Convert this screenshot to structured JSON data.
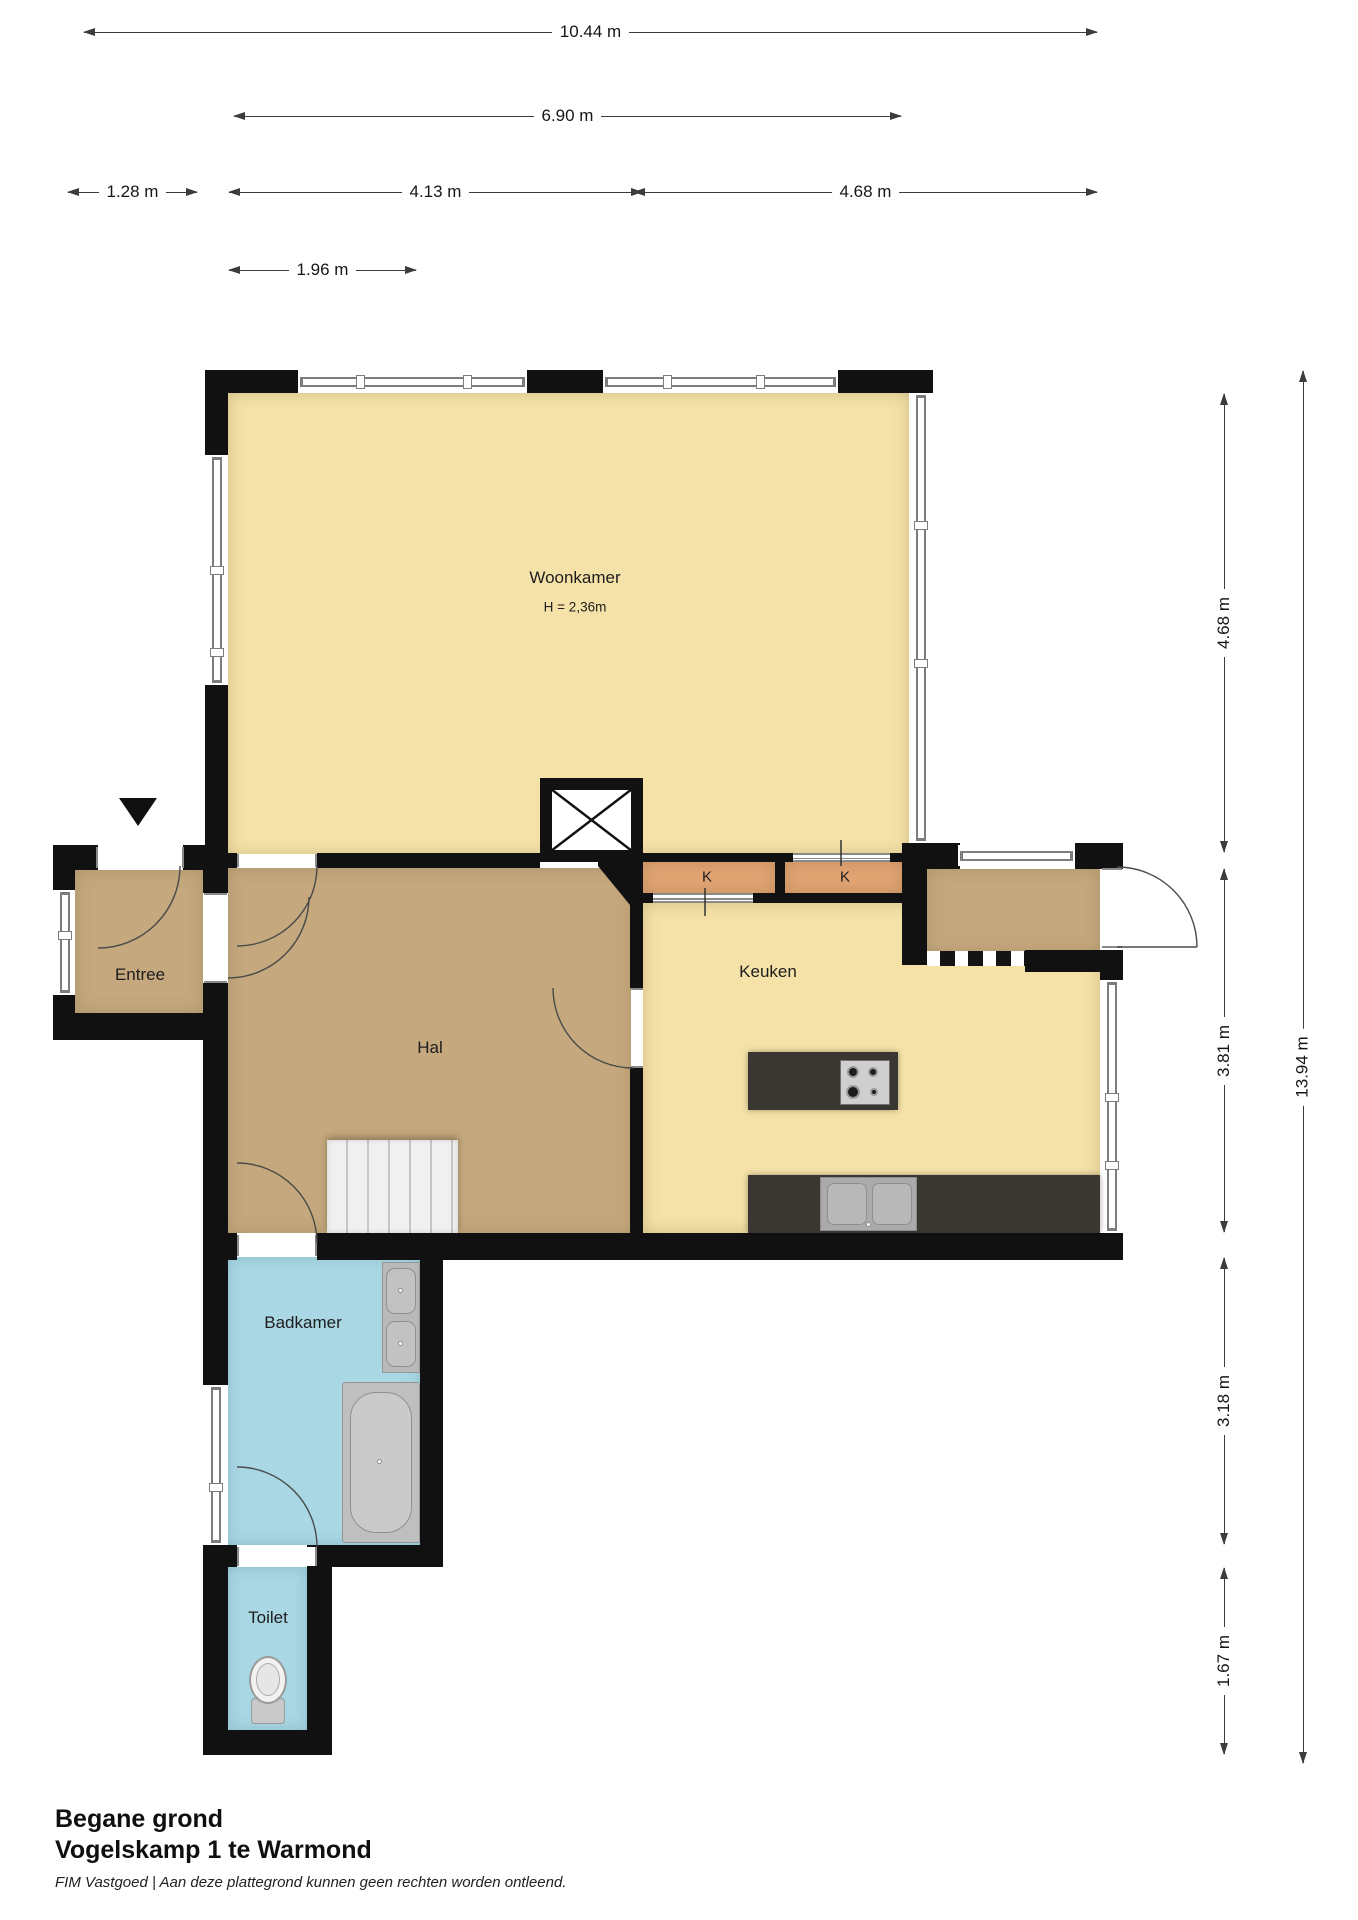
{
  "header_dims": {
    "total_width": "10.44 m",
    "upper_width": "6.90 m",
    "entree_width": "1.28 m",
    "hal_width": "4.13 m",
    "keuken_width": "4.68 m",
    "stair_width": "1.96 m"
  },
  "side_dims": {
    "woonkamer_depth": "4.68 m",
    "keuken_depth": "3.81 m",
    "badkamer_depth": "3.18 m",
    "toilet_depth": "1.67 m",
    "total_depth": "13.94 m"
  },
  "rooms": {
    "woonkamer": "Woonkamer",
    "woonkamer_height": "H = 2,36m",
    "entree": "Entree",
    "hal": "Hal",
    "keuken": "Keuken",
    "badkamer": "Badkamer",
    "toilet": "Toilet",
    "closet": "K"
  },
  "footer": {
    "floor": "Begane grond",
    "address": "Vogelskamp 1 te Warmond",
    "disclaimer": "FIM Vastgoed | Aan deze plattegrond kunnen geen rechten worden ontleend."
  },
  "colors": {
    "wall": "#111111",
    "living": "#f5e2a8",
    "hall": "#c5a87e",
    "closet": "#e2a473",
    "bath": "#a9d7e3",
    "dark": "#3a3632"
  }
}
